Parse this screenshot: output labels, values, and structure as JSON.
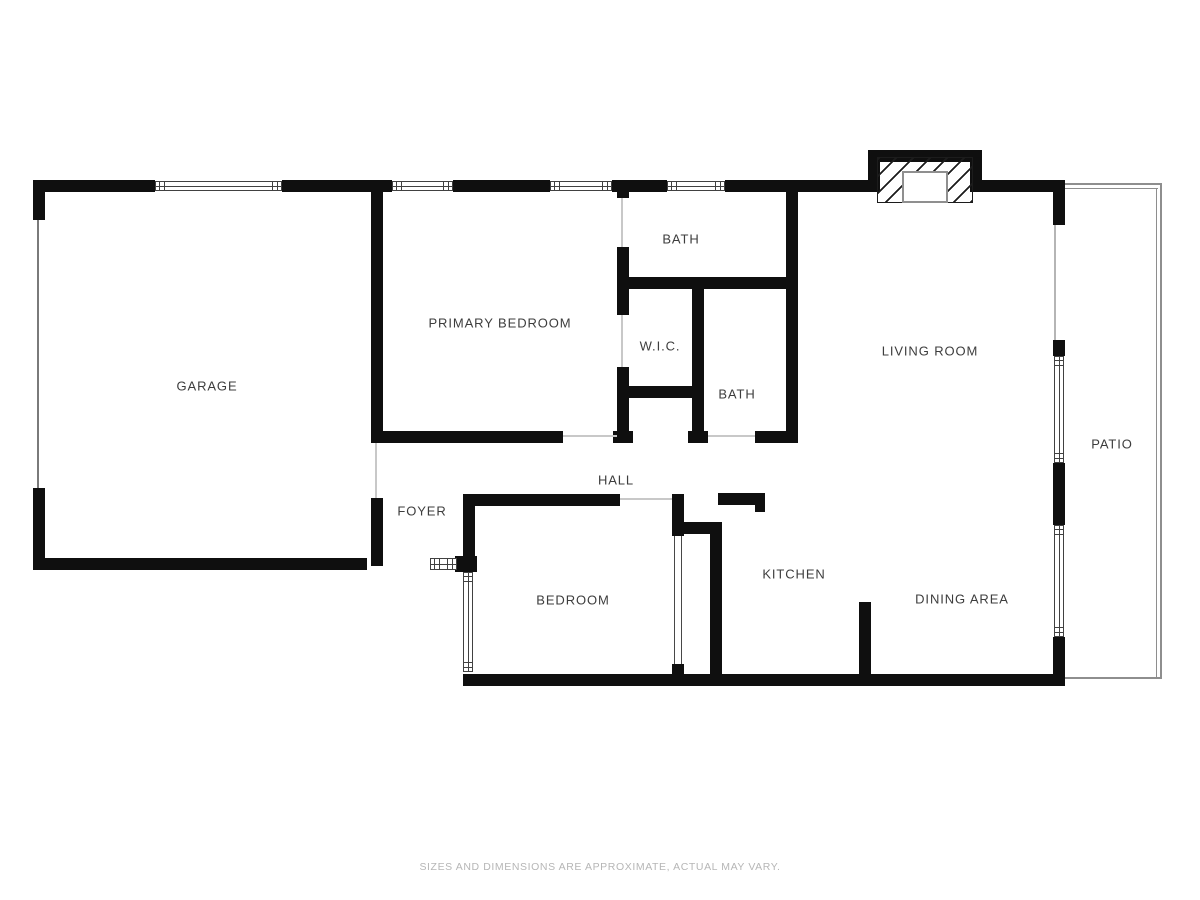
{
  "canvas": {
    "width": 1200,
    "height": 900,
    "background": "#ffffff"
  },
  "colors": {
    "wall": "#0f0f0f",
    "window_line": "#414141",
    "label_text": "#3d3d3d",
    "door_opening_line": "#c8c8c8",
    "garage_door_line": "#7a7a7a",
    "slider_line": "#b5b5b5",
    "patio_line": "#8e8e8e",
    "disclaimer_text": "#b6b6b6"
  },
  "rooms": [
    {
      "name": "garage",
      "label": "GARAGE",
      "cx": 207,
      "cy": 386
    },
    {
      "name": "primary-bedroom",
      "label": "PRIMARY BEDROOM",
      "cx": 500,
      "cy": 323
    },
    {
      "name": "bath-top",
      "label": "BATH",
      "cx": 681,
      "cy": 239
    },
    {
      "name": "wic",
      "label": "W.I.C.",
      "cx": 660,
      "cy": 346
    },
    {
      "name": "bath-hall",
      "label": "BATH",
      "cx": 737,
      "cy": 394
    },
    {
      "name": "living-room",
      "label": "LIVING ROOM",
      "cx": 930,
      "cy": 351
    },
    {
      "name": "hall",
      "label": "HALL",
      "cx": 616,
      "cy": 480
    },
    {
      "name": "foyer",
      "label": "FOYER",
      "cx": 422,
      "cy": 511
    },
    {
      "name": "bedroom",
      "label": "BEDROOM",
      "cx": 573,
      "cy": 600
    },
    {
      "name": "kitchen",
      "label": "KITCHEN",
      "cx": 794,
      "cy": 574
    },
    {
      "name": "dining-area",
      "label": "DINING AREA",
      "cx": 962,
      "cy": 599
    },
    {
      "name": "patio",
      "label": "PATIO",
      "cx": 1112,
      "cy": 444
    }
  ],
  "structure": {
    "walls": [
      [
        33,
        180,
        122,
        12
      ],
      [
        282,
        180,
        110,
        12
      ],
      [
        453,
        180,
        97,
        12
      ],
      [
        612,
        180,
        55,
        12
      ],
      [
        725,
        180,
        143,
        12
      ],
      [
        982,
        180,
        71,
        12
      ],
      [
        33,
        180,
        12,
        40
      ],
      [
        1053,
        180,
        12,
        45
      ],
      [
        33,
        488,
        12,
        80
      ],
      [
        33,
        558,
        334,
        12
      ],
      [
        371,
        180,
        12,
        263
      ],
      [
        371,
        498,
        12,
        68
      ],
      [
        371,
        431,
        192,
        12
      ],
      [
        617,
        192,
        12,
        6
      ],
      [
        617,
        247,
        12,
        68
      ],
      [
        617,
        367,
        12,
        64
      ],
      [
        613,
        431,
        20,
        12
      ],
      [
        625,
        277,
        173,
        12
      ],
      [
        692,
        289,
        12,
        142
      ],
      [
        688,
        431,
        20,
        12
      ],
      [
        617,
        386,
        87,
        12
      ],
      [
        755,
        431,
        43,
        12
      ],
      [
        786,
        192,
        12,
        251
      ],
      [
        463,
        494,
        157,
        12
      ],
      [
        672,
        494,
        12,
        42
      ],
      [
        672,
        522,
        50,
        12
      ],
      [
        710,
        522,
        12,
        158
      ],
      [
        718,
        493,
        47,
        12
      ],
      [
        755,
        493,
        10,
        19
      ],
      [
        463,
        494,
        12,
        68
      ],
      [
        455,
        556,
        22,
        16
      ],
      [
        463,
        674,
        602,
        12
      ],
      [
        672,
        664,
        12,
        12
      ],
      [
        859,
        602,
        12,
        84
      ],
      [
        1053,
        340,
        12,
        16
      ],
      [
        1053,
        463,
        12,
        62
      ],
      [
        1053,
        637,
        12,
        49
      ]
    ],
    "windows": [
      {
        "x": 155,
        "y": 181,
        "w": 127,
        "h": 10,
        "dir": "h"
      },
      {
        "x": 392,
        "y": 181,
        "w": 61,
        "h": 10,
        "dir": "h"
      },
      {
        "x": 550,
        "y": 181,
        "w": 62,
        "h": 10,
        "dir": "h"
      },
      {
        "x": 667,
        "y": 181,
        "w": 58,
        "h": 10,
        "dir": "h"
      },
      {
        "x": 1054,
        "y": 356,
        "w": 10,
        "h": 107,
        "dir": "v"
      },
      {
        "x": 1054,
        "y": 525,
        "w": 10,
        "h": 112,
        "dir": "v"
      },
      {
        "x": 463,
        "y": 572,
        "w": 10,
        "h": 100,
        "dir": "v"
      },
      {
        "x": 430,
        "y": 558,
        "w": 27,
        "h": 12,
        "dir": "h"
      }
    ],
    "thin_lines": [
      {
        "x": 37,
        "y": 220,
        "w": 2,
        "h": 268,
        "c": "#7a7a7a",
        "name": "garage-vehicle-door-line"
      },
      {
        "x": 375,
        "y": 443,
        "w": 2,
        "h": 55,
        "c": "#c8c8c8",
        "name": "garage-entry-door-opening"
      },
      {
        "x": 621,
        "y": 198,
        "w": 2,
        "h": 49,
        "c": "#c8c8c8",
        "name": "bath-top-door-opening"
      },
      {
        "x": 621,
        "y": 315,
        "w": 2,
        "h": 52,
        "c": "#c8c8c8",
        "name": "wic-door-opening"
      },
      {
        "x": 563,
        "y": 435,
        "w": 54,
        "h": 2,
        "c": "#c8c8c8",
        "name": "primary-bedroom-door-opening"
      },
      {
        "x": 708,
        "y": 435,
        "w": 47,
        "h": 2,
        "c": "#c8c8c8",
        "name": "bath-hall-door-opening"
      },
      {
        "x": 620,
        "y": 498,
        "w": 52,
        "h": 2,
        "c": "#c8c8c8",
        "name": "bedroom-door-opening"
      },
      {
        "x": 1054,
        "y": 225,
        "w": 2,
        "h": 115,
        "c": "#b5b5b5",
        "name": "patio-slider-opening"
      },
      {
        "x": 1065,
        "y": 183,
        "w": 97,
        "h": 2,
        "c": "#8e8e8e",
        "name": "patio-edge-top"
      },
      {
        "x": 1065,
        "y": 188,
        "w": 93,
        "h": 1,
        "c": "#8e8e8e",
        "name": "patio-edge-top-inner"
      },
      {
        "x": 1160,
        "y": 183,
        "w": 2,
        "h": 496,
        "c": "#8e8e8e",
        "name": "patio-edge-right"
      },
      {
        "x": 1156,
        "y": 188,
        "w": 1,
        "h": 489,
        "c": "#8e8e8e",
        "name": "patio-edge-right-inner"
      },
      {
        "x": 1065,
        "y": 677,
        "w": 96,
        "h": 2,
        "c": "#8e8e8e",
        "name": "patio-edge-bottom"
      }
    ],
    "closet_door": {
      "x": 674,
      "y": 536,
      "w": 8,
      "h": 128
    },
    "fireplace": {
      "chimney": [
        [
          868,
          150,
          114,
          12
        ],
        [
          868,
          150,
          12,
          42
        ],
        [
          970,
          150,
          12,
          42
        ]
      ],
      "hatch": {
        "x": 877,
        "y": 157,
        "w": 96,
        "h": 46
      },
      "firebox": {
        "x": 902,
        "y": 171,
        "w": 46,
        "h": 32
      }
    }
  },
  "footer": {
    "text": "SIZES AND DIMENSIONS ARE APPROXIMATE, ACTUAL MAY VARY."
  }
}
